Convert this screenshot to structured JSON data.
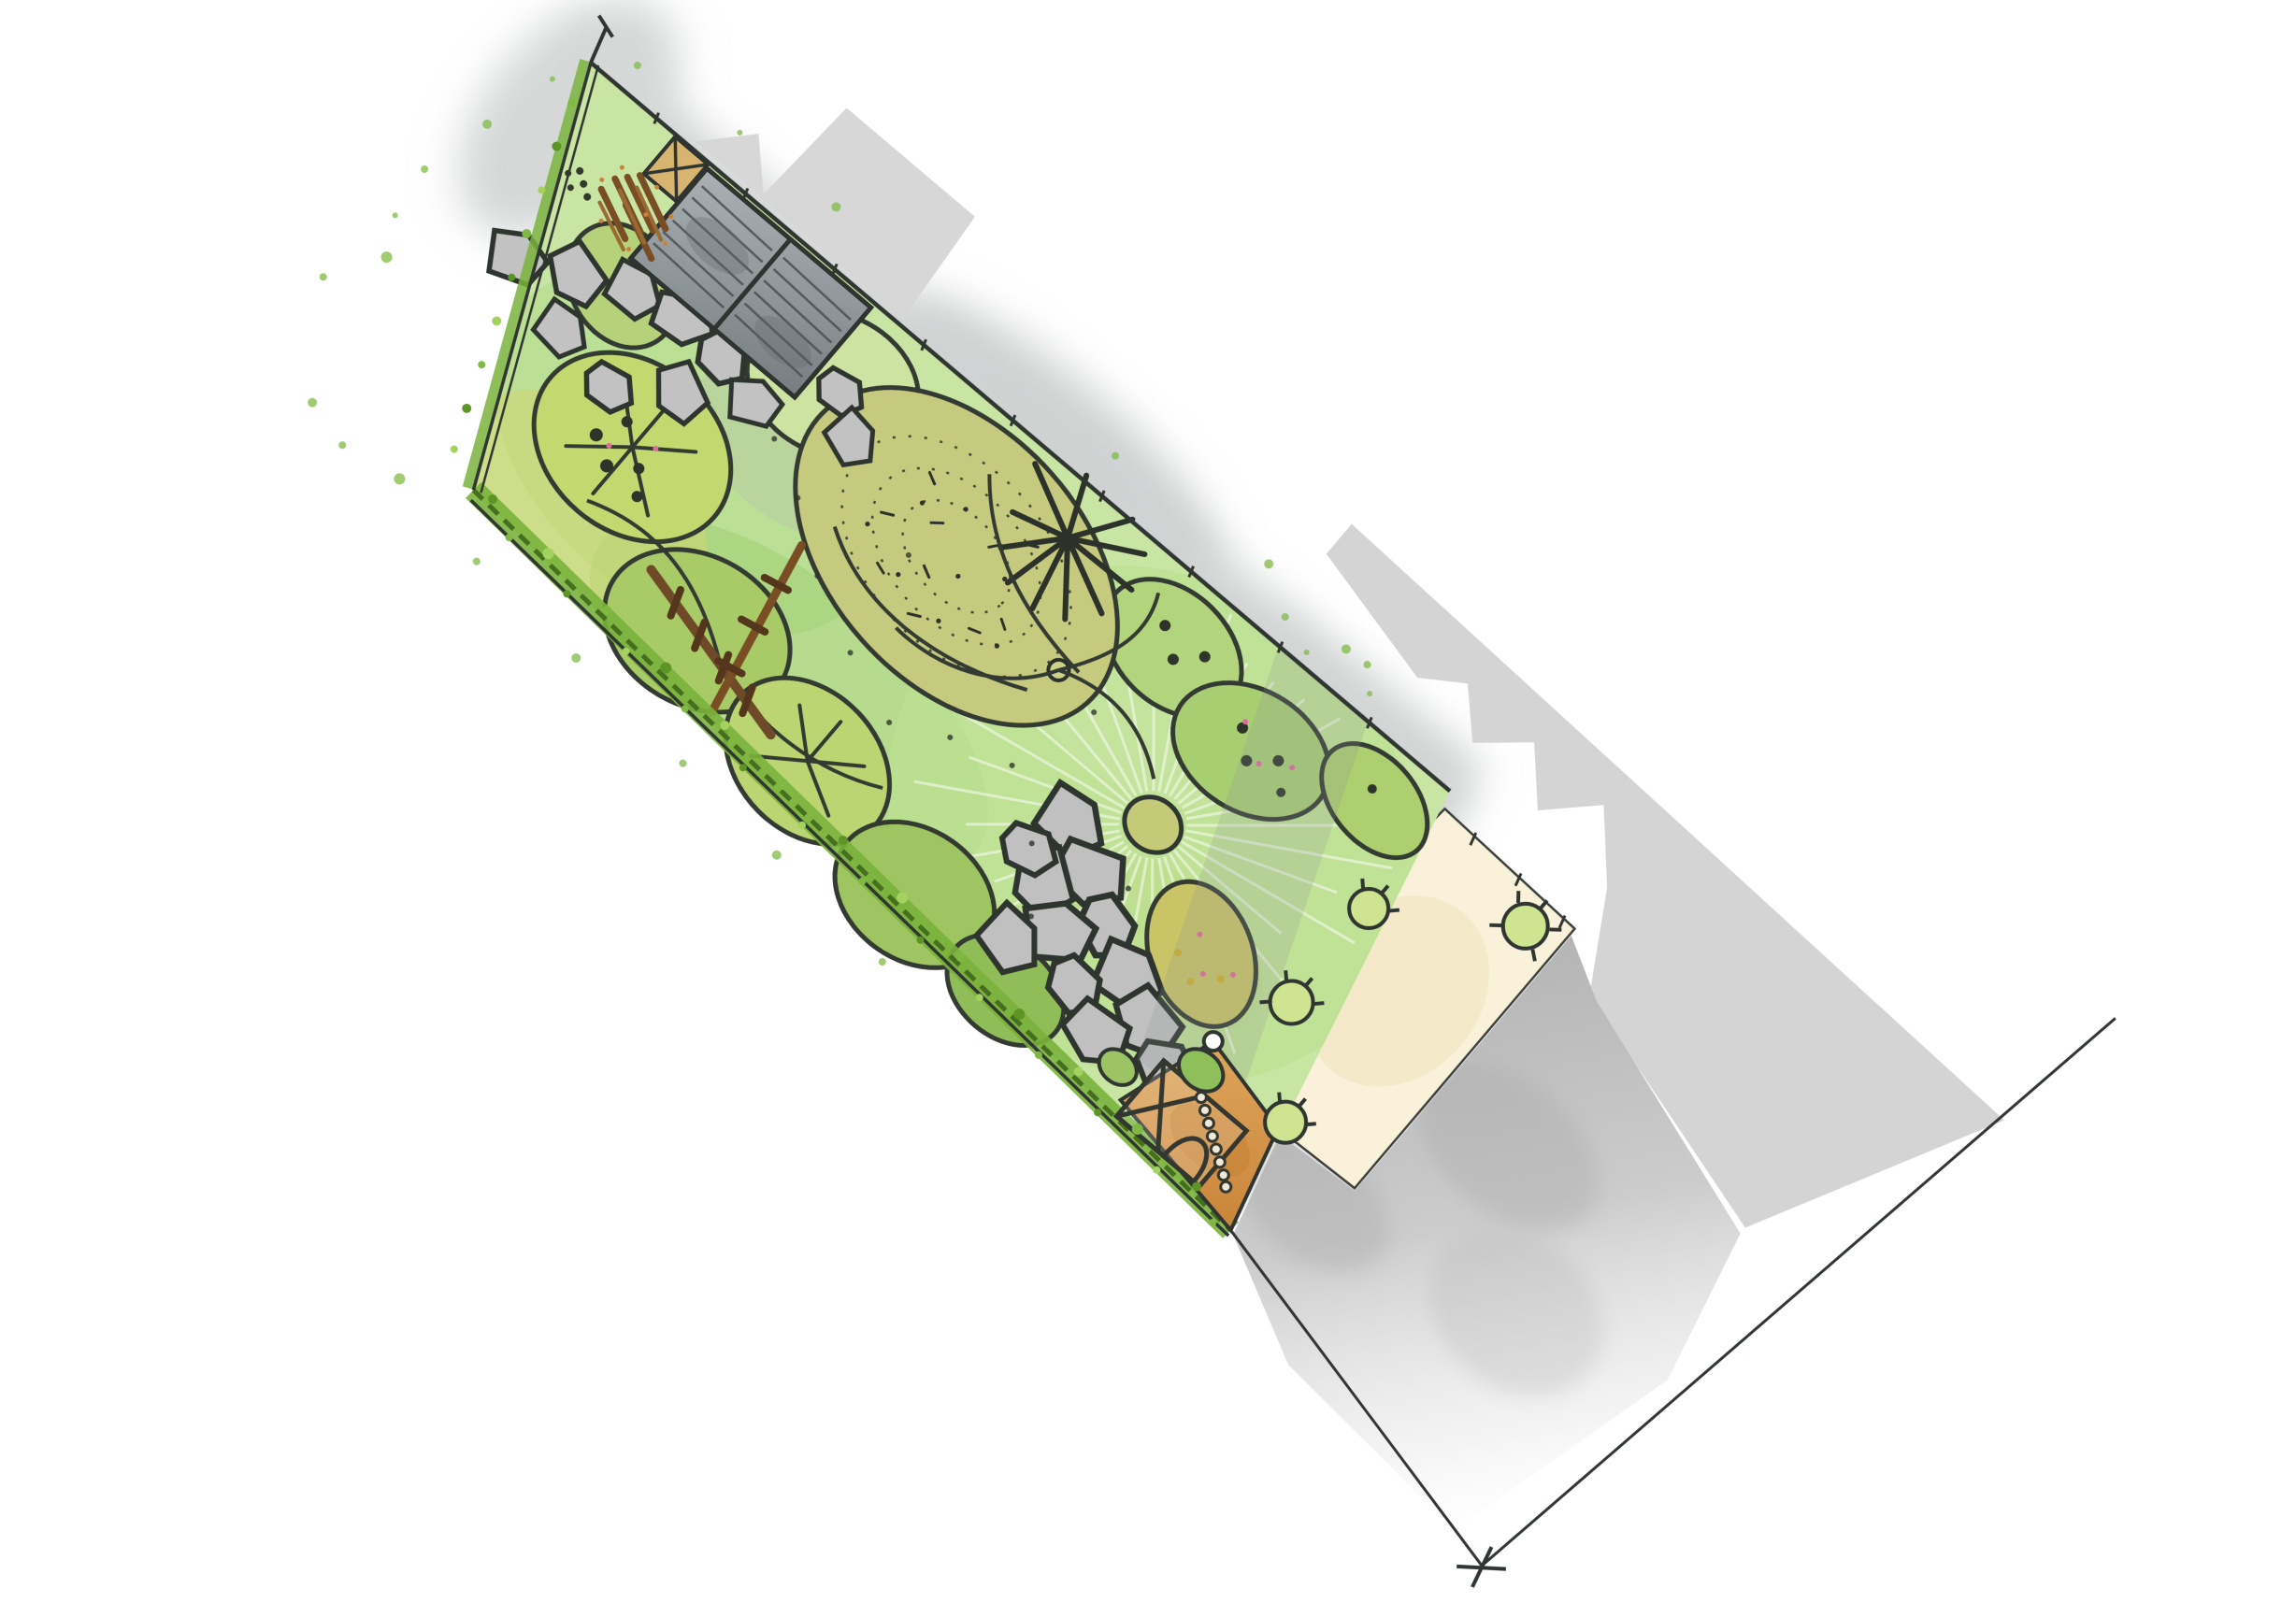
{
  "meta": {
    "title": "Garden design plan - watercolour sketch",
    "description": "Hand-drawn top-view landscape garden plan rotated diagonally on a white sheet: tapered garden plot with lawn sunburst, planting beds, tree canopies, shed with log store, stepping stone paths, timber pergola, greenhouse on gravel, house terrace with potted plants, existing grey patio and flat grey neighbouring buildings",
    "background": "#ffffff",
    "plan_rotation_deg": 40.3
  },
  "palette": {
    "lawn_green": "#c9e5a4",
    "lawn_light": "#bce092",
    "canopy_green": "#a9cb67",
    "canopy_yellow": "#c6d96b",
    "bed_olive": "#c6ca7e",
    "hedge_green": "#7ab33c",
    "hedge_dark": "#456f1f",
    "stone_grey": "#c2c2c2",
    "outline_ink": "#2f3530",
    "timber_brown": "#7a4e24",
    "gravel_orange": "#d89a4d",
    "terrace_cream": "#f9f1d9",
    "patio_grey": "#c3c3c3",
    "building_grey": "#d7d7d7",
    "log_brown": "#8a5a2b",
    "door_tan": "#d7b570",
    "accent_pink": "#e06c9f",
    "shadow_grey": "#a9adad"
  },
  "features": [
    {
      "name": "garden-plot",
      "label": "tapered garden plot"
    },
    {
      "name": "lawn-sunburst",
      "label": "circular lawn with radiating mow lines"
    },
    {
      "name": "lawn-feature-circle",
      "label": "central feature circle"
    },
    {
      "name": "planting-bed",
      "label": "stippled specimen planting bed"
    },
    {
      "name": "fern-specimen",
      "label": "architectural fern / palm symbol"
    },
    {
      "name": "tree-canopies",
      "label": "outlined tree and shrub canopies"
    },
    {
      "name": "shed",
      "label": "two-bay timber shed with decking planks"
    },
    {
      "name": "log-store",
      "label": "log store pile"
    },
    {
      "name": "store-door",
      "label": "small store with cross-braced door"
    },
    {
      "name": "stepping-stones-upper",
      "label": "upper stepping stone path"
    },
    {
      "name": "stepping-stones-lower",
      "label": "lower stepping stone path to gate"
    },
    {
      "name": "timber-pergola",
      "label": "rustic timber pole steps"
    },
    {
      "name": "boundary-hedge",
      "label": "speckled boundary hedge"
    },
    {
      "name": "boundary-fence",
      "label": "boundary fence lines with post ticks"
    },
    {
      "name": "greenhouse",
      "label": "greenhouse / cold frame on gravel"
    },
    {
      "name": "gravel-area",
      "label": "orange gravel utility corner"
    },
    {
      "name": "access-gate",
      "label": "gate post circle"
    },
    {
      "name": "house-terrace",
      "label": "cream house terrace"
    },
    {
      "name": "potted-plants",
      "label": "potted plants on terrace"
    },
    {
      "name": "existing-patio",
      "label": "grey watercolour patio / drive"
    },
    {
      "name": "neighbour-building-north",
      "label": "flat grey neighbouring building (north)"
    },
    {
      "name": "neighbour-building-east",
      "label": "flat grey neighbouring building range (east)"
    },
    {
      "name": "building-shadow",
      "label": "cast shadow band across lawn"
    },
    {
      "name": "site-boundary-extension",
      "label": "surveyed site boundary extension lines"
    },
    {
      "name": "survey-corner-mark",
      "label": "survey corner tick marks"
    }
  ]
}
